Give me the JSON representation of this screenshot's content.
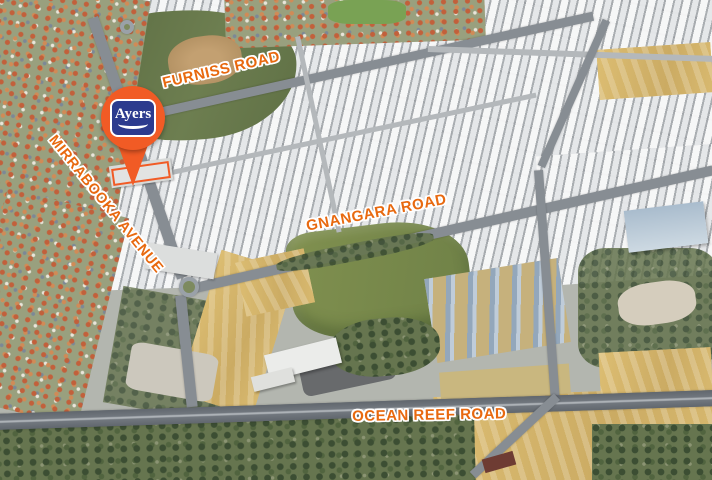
{
  "map": {
    "labels": {
      "furniss": "FURNISS ROAD",
      "mirrabooka": "MIRRABOOKA AVENUE",
      "gnangara": "GNANGARA ROAD",
      "ocean_reef": "OCEAN REEF ROAD"
    },
    "pin": {
      "logo_text": "Ayers"
    },
    "colors": {
      "label_orange": "#E8690F",
      "label_outline": "#FFFFFF",
      "pin_orange": "#F15B25",
      "logo_navy": "#2C3B8E",
      "highway_gray": "#656B72",
      "sand_yellow": "#D5B56C",
      "bush_green": "#66754F",
      "field_green": "#5F7045"
    }
  }
}
